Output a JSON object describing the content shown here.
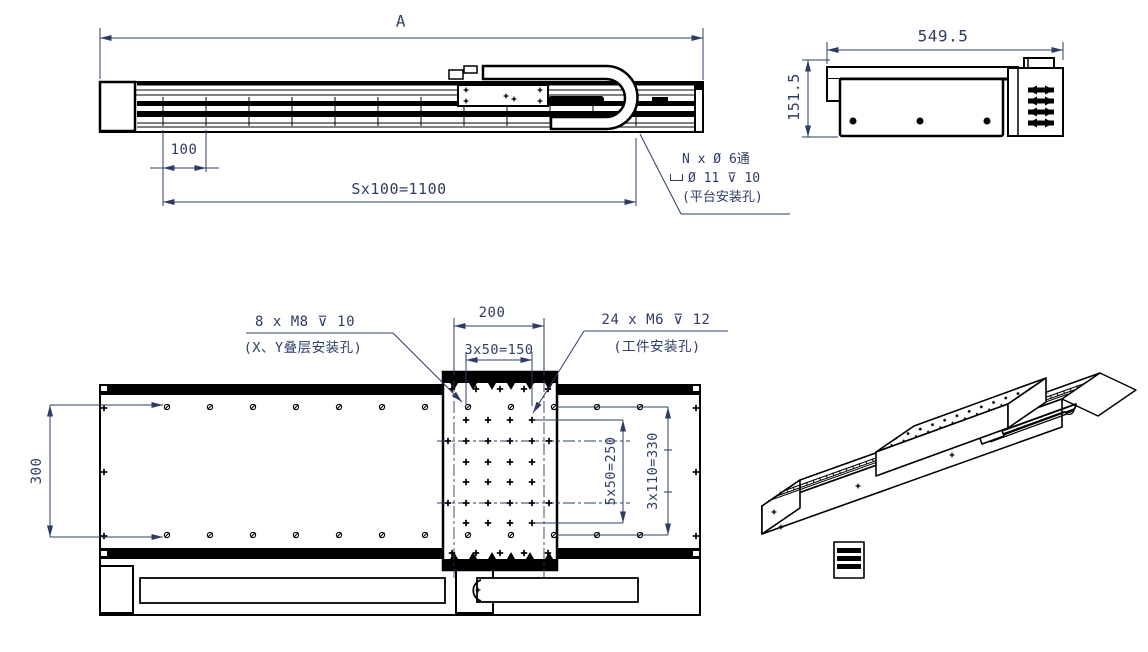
{
  "drawing": {
    "background": "#ffffff",
    "line_color": "#000000",
    "dim_color": "#2e3c66",
    "side_view": {
      "dim_overall_length": "A",
      "dim_first_pitch": "100",
      "dim_hole_pitch_total": "Sx100=1100",
      "callout_platform_holes": {
        "line1": "N x Ø 6通",
        "line2_symbol": "counterbore-symbol",
        "line2": "Ø 11 ⊽ 10",
        "line3": "(平台安装孔)"
      }
    },
    "end_view": {
      "dim_width": "549.5",
      "dim_height": "151.5"
    },
    "plan_view": {
      "dim_rail_width": "300",
      "dim_carriage_width": "200",
      "dim_hole_span_x": "3x50=150",
      "dim_hole_span_y": "5x50=250",
      "dim_outer_hole_span_y": "3x110=330",
      "callout_stack_holes": {
        "line1": "8 x M8 ⊽ 10",
        "line2": "(X、Y叠层安装孔)"
      },
      "callout_work_holes": {
        "line1": "24 x M6  ⊽ 12",
        "line2": "(工件安装孔)"
      }
    }
  }
}
